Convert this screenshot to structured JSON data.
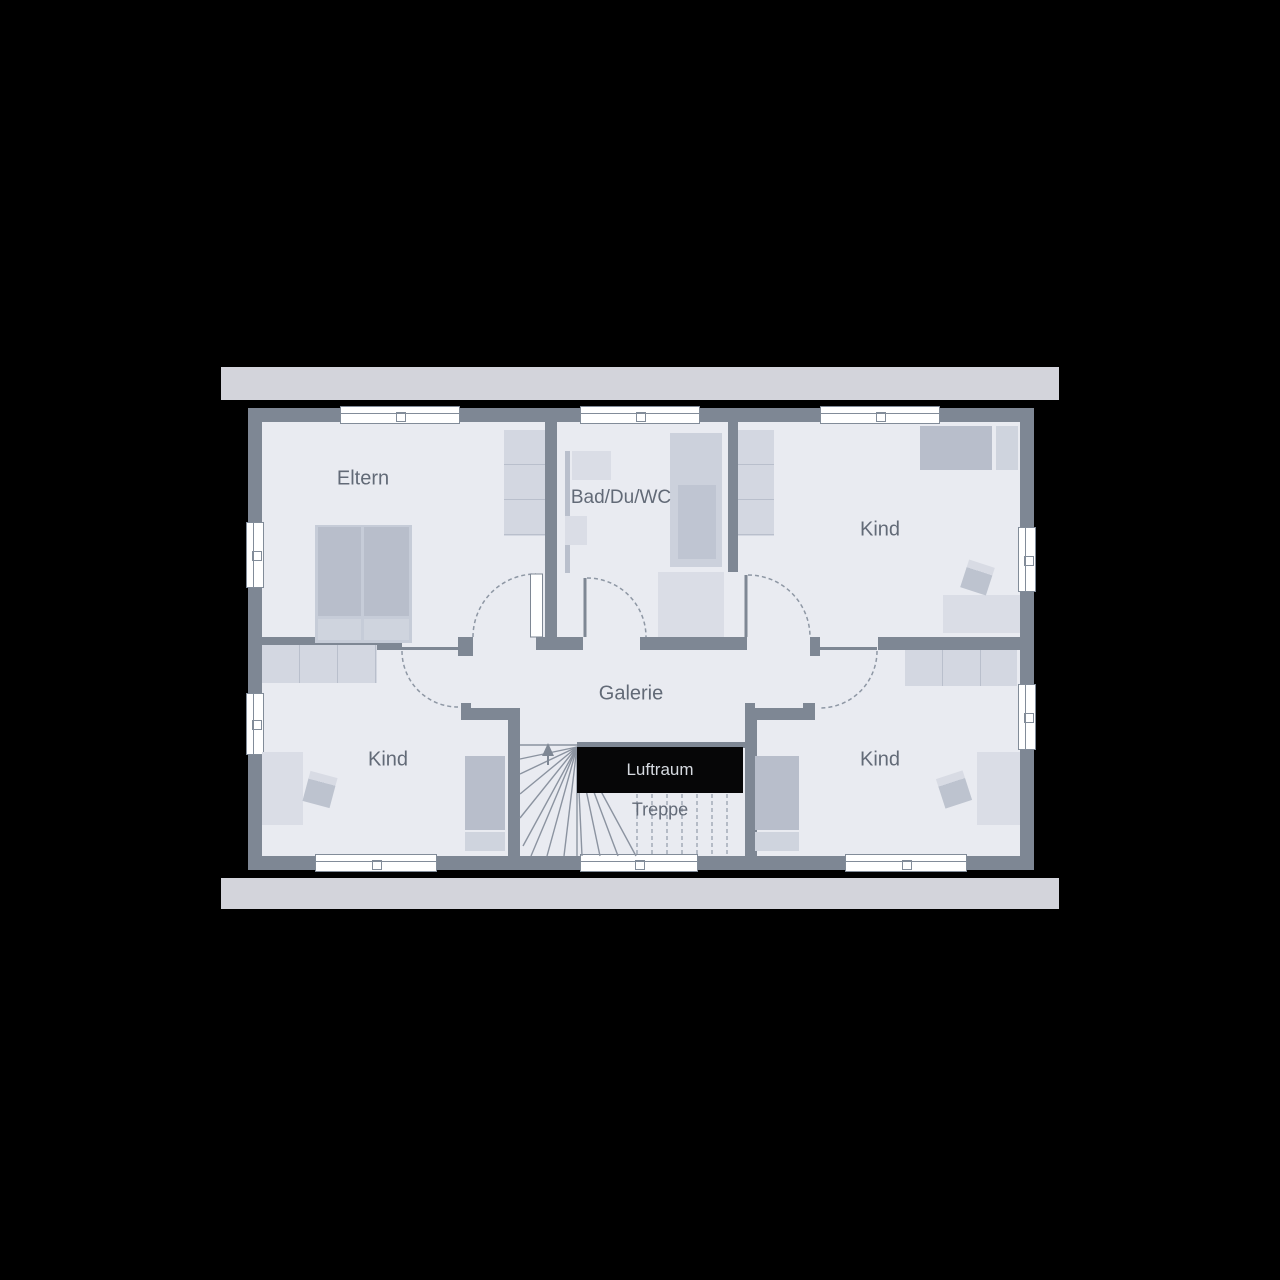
{
  "plan": {
    "type": "floor-plan",
    "labels": {
      "eltern": "Eltern",
      "bath": "Bad/Du/WC",
      "kind_top_right": "Kind",
      "kind_bottom_left": "Kind",
      "kind_bottom_right": "Kind",
      "galerie": "Galerie",
      "luftraum": "Luftraum",
      "treppe": "Treppe"
    },
    "colors": {
      "background": "#000000",
      "wall": "#7e8794",
      "floor": "#e9ebf1",
      "roof_overhang": "#d3d4db",
      "luftraum_fill": "#060607",
      "label_text": "#626a77"
    }
  }
}
